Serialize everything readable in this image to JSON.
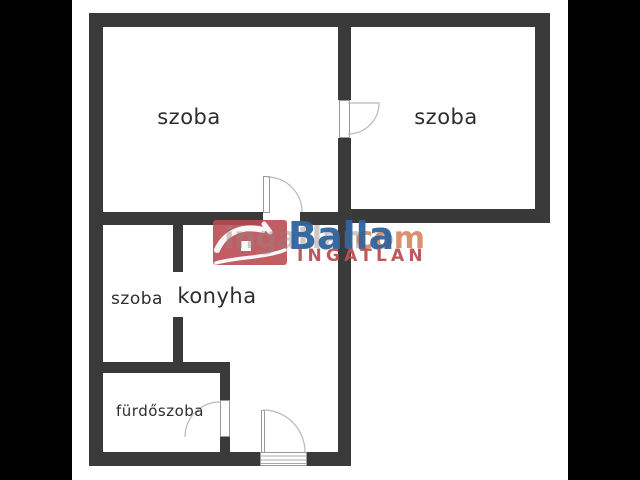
{
  "rooms": {
    "top_left": {
      "label": "szoba"
    },
    "top_right": {
      "label": "szoba"
    },
    "small": {
      "label": "szoba"
    },
    "kitchen": {
      "label": "konyha"
    },
    "bathroom": {
      "label": "fürdőszoba"
    }
  },
  "watermark": {
    "site_name": "ingatlan",
    "site_tld": ".com",
    "brand": "Balla",
    "brand_subtitle": "INGATLAN",
    "colors": {
      "brand_blue": "#2f639e",
      "brand_red": "#b94f53",
      "logo_box_red": "#b94d53",
      "tld_orange": "#cf7a52",
      "wall_gray": "#3a3a3a"
    }
  }
}
